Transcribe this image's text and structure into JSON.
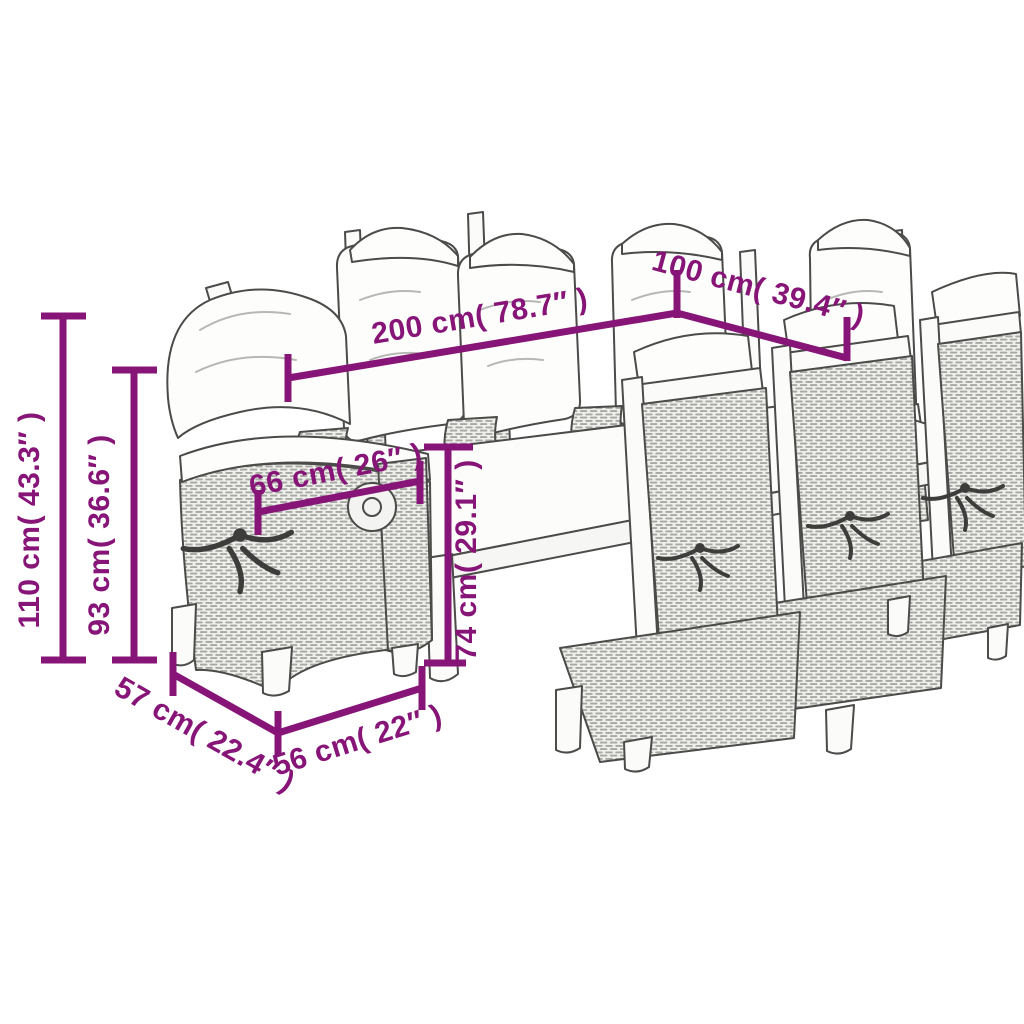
{
  "diagram": {
    "type": "product-dimension-illustration",
    "subject": "outdoor-dining-table-with-eight-reclining-chairs",
    "colors": {
      "accent": "#871578",
      "line_art_outline": "#4b4b49",
      "background": "#ffffff"
    },
    "dims": {
      "table_length": "200 cm( 78.7″ )",
      "table_depth": "100 cm( 39.4″ )",
      "total_height": "110 cm( 43.3″ )",
      "back_height": "93 cm( 36.6″ )",
      "seat_width": "66 cm( 26″ )",
      "table_height": "74 cm( 29.1″ )",
      "seat_depth": "57 cm( 22.4″ )",
      "chair_width": "56 cm( 22″ )"
    }
  }
}
